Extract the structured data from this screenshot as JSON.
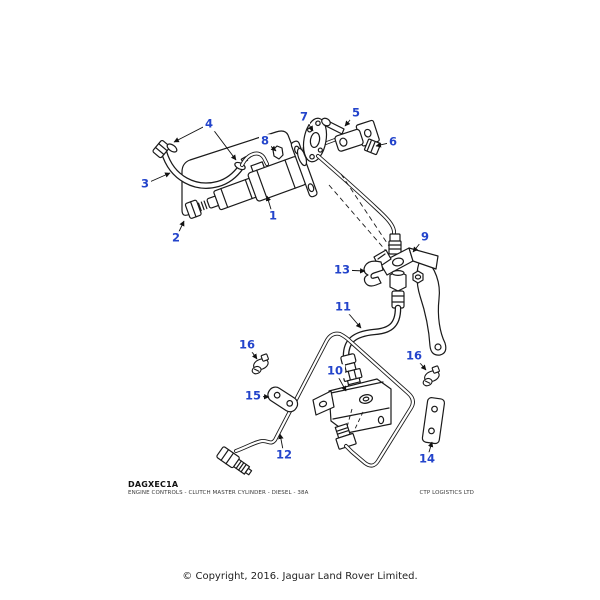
{
  "diagram": {
    "code": "DAGXEC1A",
    "subtitle": "ENGINE CONTROLS - CLUTCH MASTER CYLINDER - DIESEL - 38A",
    "vendor": "CTP LOGISTICS LTD",
    "copyright": "© Copyright, 2016. Jaguar Land Rover Limited.",
    "accent_color": "#2344CB",
    "line_color": "#1a1a1a",
    "callouts": [
      {
        "number": "1",
        "x": 273,
        "y": 216,
        "leaders": [
          [
            267,
            196
          ]
        ]
      },
      {
        "number": "2",
        "x": 176,
        "y": 238,
        "leaders": [
          [
            184,
            221
          ]
        ]
      },
      {
        "number": "3",
        "x": 145,
        "y": 184,
        "leaders": [
          [
            170,
            173
          ]
        ]
      },
      {
        "number": "4",
        "x": 209,
        "y": 124,
        "leaders": [
          [
            174,
            142
          ],
          [
            236,
            160
          ]
        ]
      },
      {
        "number": "5",
        "x": 356,
        "y": 113,
        "leaders": [
          [
            345,
            126
          ]
        ]
      },
      {
        "number": "6",
        "x": 393,
        "y": 142,
        "leaders": [
          [
            376,
            146
          ]
        ]
      },
      {
        "number": "7",
        "x": 304,
        "y": 117,
        "leaders": [
          [
            313,
            131
          ]
        ]
      },
      {
        "number": "8",
        "x": 265,
        "y": 141,
        "leaders": [
          [
            276,
            151
          ]
        ]
      },
      {
        "number": "9",
        "x": 425,
        "y": 237,
        "leaders": [
          [
            413,
            252
          ]
        ]
      },
      {
        "number": "10",
        "x": 335,
        "y": 371,
        "leaders": [
          [
            346,
            391
          ]
        ]
      },
      {
        "number": "11",
        "x": 343,
        "y": 307,
        "leaders": [
          [
            361,
            328
          ]
        ]
      },
      {
        "number": "12",
        "x": 284,
        "y": 455,
        "leaders": [
          [
            280,
            434
          ]
        ]
      },
      {
        "number": "13",
        "x": 342,
        "y": 270,
        "leaders": [
          [
            365,
            271
          ]
        ]
      },
      {
        "number": "14",
        "x": 427,
        "y": 459,
        "leaders": [
          [
            432,
            442
          ]
        ]
      },
      {
        "number": "15",
        "x": 253,
        "y": 396,
        "leaders": [
          [
            269,
            397
          ]
        ]
      },
      {
        "number": "16",
        "x": 247,
        "y": 345,
        "leaders": [
          [
            257,
            359
          ]
        ]
      },
      {
        "number": "16",
        "x": 414,
        "y": 356,
        "leaders": [
          [
            426,
            370
          ]
        ]
      }
    ]
  }
}
